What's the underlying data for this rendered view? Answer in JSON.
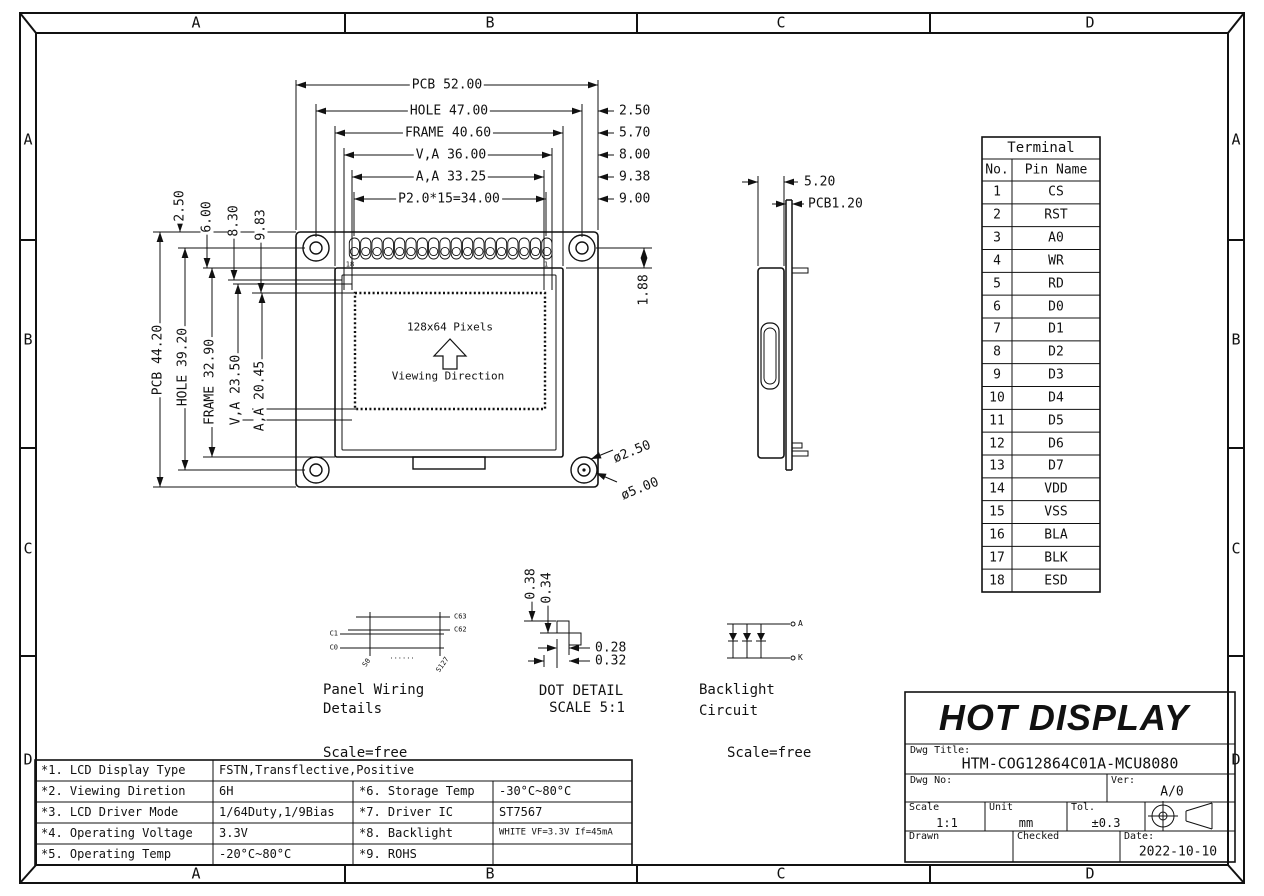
{
  "zones": {
    "letters": [
      "A",
      "B",
      "C",
      "D"
    ]
  },
  "front_view": {
    "dims_top": [
      "PCB 52.00",
      "HOLE 47.00",
      "FRAME 40.60",
      "V,A 36.00",
      "A,A 33.25",
      "P2.0*15=34.00"
    ],
    "dims_right": [
      "2.50",
      "5.70",
      "8.00",
      "9.38",
      "9.00"
    ],
    "dims_left_top": [
      "2.50",
      "6.00",
      "8.30",
      "9.83"
    ],
    "dims_left": [
      "PCB 44.20",
      "HOLE 39.20",
      "FRAME 32.90",
      "V,A 23.50",
      "A,A 20.45"
    ],
    "pad_dim": "1.88",
    "pin_label_left": "18",
    "pin_label_right": "1",
    "display_text": "128x64 Pixels",
    "viewing_text": "Viewing Direction",
    "hole_dia_small": "ø2.50",
    "hole_dia_large": "ø5.00"
  },
  "side_view": {
    "dim_width": "5.20",
    "dim_pcb": "PCB1.20"
  },
  "terminal_table": {
    "title": "Terminal",
    "col_no": "No.",
    "col_name": "Pin Name",
    "rows": [
      [
        "1",
        "CS"
      ],
      [
        "2",
        "RST"
      ],
      [
        "3",
        "A0"
      ],
      [
        "4",
        "WR"
      ],
      [
        "5",
        "RD"
      ],
      [
        "6",
        "D0"
      ],
      [
        "7",
        "D1"
      ],
      [
        "8",
        "D2"
      ],
      [
        "9",
        "D3"
      ],
      [
        "10",
        "D4"
      ],
      [
        "11",
        "D5"
      ],
      [
        "12",
        "D6"
      ],
      [
        "13",
        "D7"
      ],
      [
        "14",
        "VDD"
      ],
      [
        "15",
        "VSS"
      ],
      [
        "16",
        "BLA"
      ],
      [
        "17",
        "BLK"
      ],
      [
        "18",
        "ESD"
      ]
    ]
  },
  "panel_wiring": {
    "title1": "Panel Wiring",
    "title2": "Details",
    "scale": "Scale=free",
    "label_c63": "C63",
    "label_c62": "C62",
    "label_c1": "C1",
    "label_c0": "C0",
    "label_s0": "S0",
    "label_dots": "......",
    "label_s127": "S127"
  },
  "dot_detail": {
    "title": "DOT DETAIL",
    "scale": "SCALE 5:1",
    "dim_h1": "0.38",
    "dim_h2": "0.34",
    "dim_w1": "0.28",
    "dim_w2": "0.32"
  },
  "backlight_circuit": {
    "title1": "Backlight",
    "title2": "Circuit",
    "scale": "Scale=free",
    "anode": "A",
    "cathode": "K"
  },
  "spec_table": {
    "r1_label": "*1. LCD Display Type",
    "r1_value": "FSTN,Transflective,Positive",
    "r2_label": "*2. Viewing Diretion",
    "r2_value": "6H",
    "r2_label2": "*6. Storage Temp",
    "r2_value2": "-30°C~80°C",
    "r3_label": "*3. LCD Driver Mode",
    "r3_value": "1/64Duty,1/9Bias",
    "r3_label2": "*7. Driver IC",
    "r3_value2": "ST7567",
    "r4_label": "*4. Operating Voltage",
    "r4_value": "3.3V",
    "r4_label2": "*8. Backlight",
    "r4_value2": "WHITE VF=3.3V If=45mA",
    "r5_label": "*5. Operating Temp",
    "r5_value": "-20°C~80°C",
    "r5_label2": "*9. ROHS",
    "r5_value2": ""
  },
  "title_block": {
    "company": "HOT DISPLAY",
    "dwg_title_label": "Dwg Title:",
    "dwg_title": "HTM-COG12864C01A-MCU8080",
    "dwg_no_label": "Dwg No:",
    "ver_label": "Ver:",
    "ver": "A/0",
    "scale_label": "Scale",
    "scale": "1:1",
    "unit_label": "Unit",
    "unit": "mm",
    "tol_label": "Tol.",
    "tol": "±0.3",
    "drawn_label": "Drawn",
    "checked_label": "Checked",
    "date_label": "Date:",
    "date": "2022-10-10"
  }
}
